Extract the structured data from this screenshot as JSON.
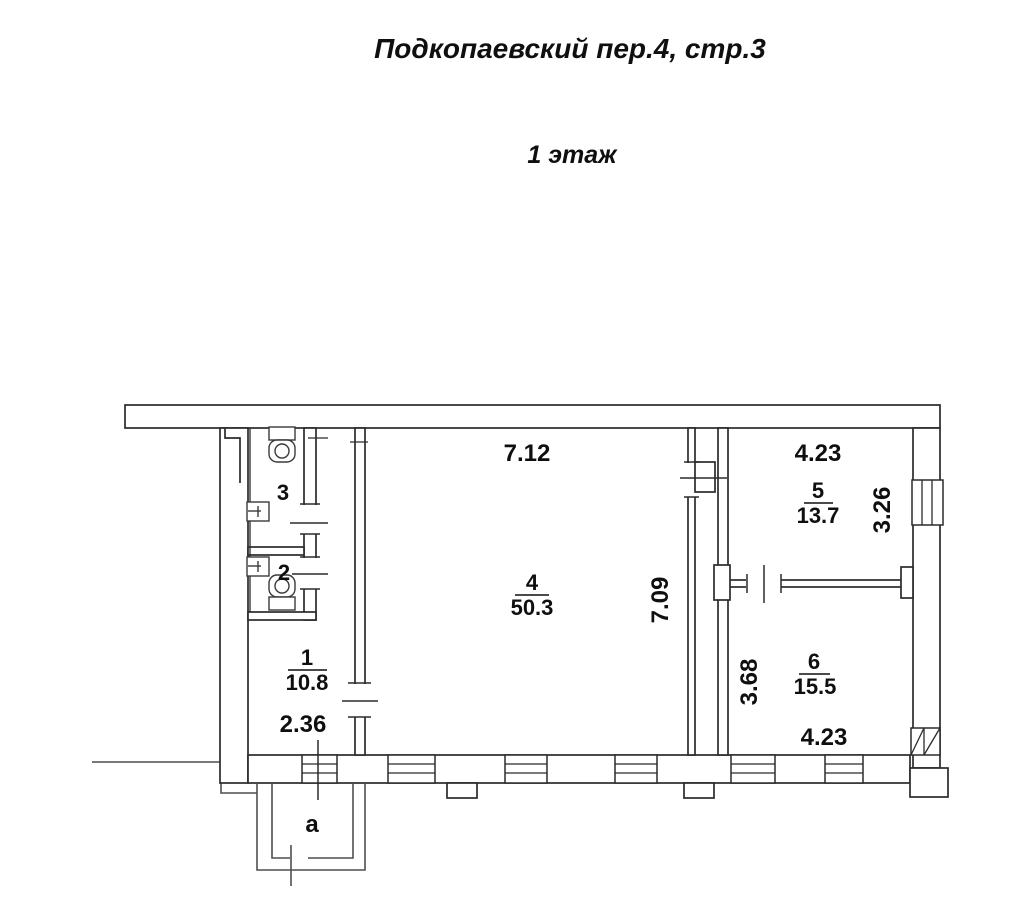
{
  "header": {
    "title": "Подкопаевский пер.4, стр.3",
    "subtitle": "1 этаж"
  },
  "floor_plan": {
    "rooms": {
      "room1": {
        "number": "1",
        "area": "10.8"
      },
      "room2": {
        "number": "2"
      },
      "room3": {
        "number": "3"
      },
      "room4": {
        "number": "4",
        "area": "50.3"
      },
      "room5": {
        "number": "5",
        "area": "13.7"
      },
      "room6": {
        "number": "6",
        "area": "15.5"
      },
      "annex": {
        "label": "а"
      }
    },
    "dimensions": {
      "room1_width": "2.36",
      "room4_width": "7.12",
      "room4_depth": "7.09",
      "room5_width": "4.23",
      "room5_depth": "3.26",
      "room6_width": "4.23",
      "room6_depth": "3.68"
    },
    "colors": {
      "wall": "#2b2b2b",
      "secondary": "#4f4f4f",
      "text": "#0f0f0f",
      "background": "#ffffff"
    }
  }
}
